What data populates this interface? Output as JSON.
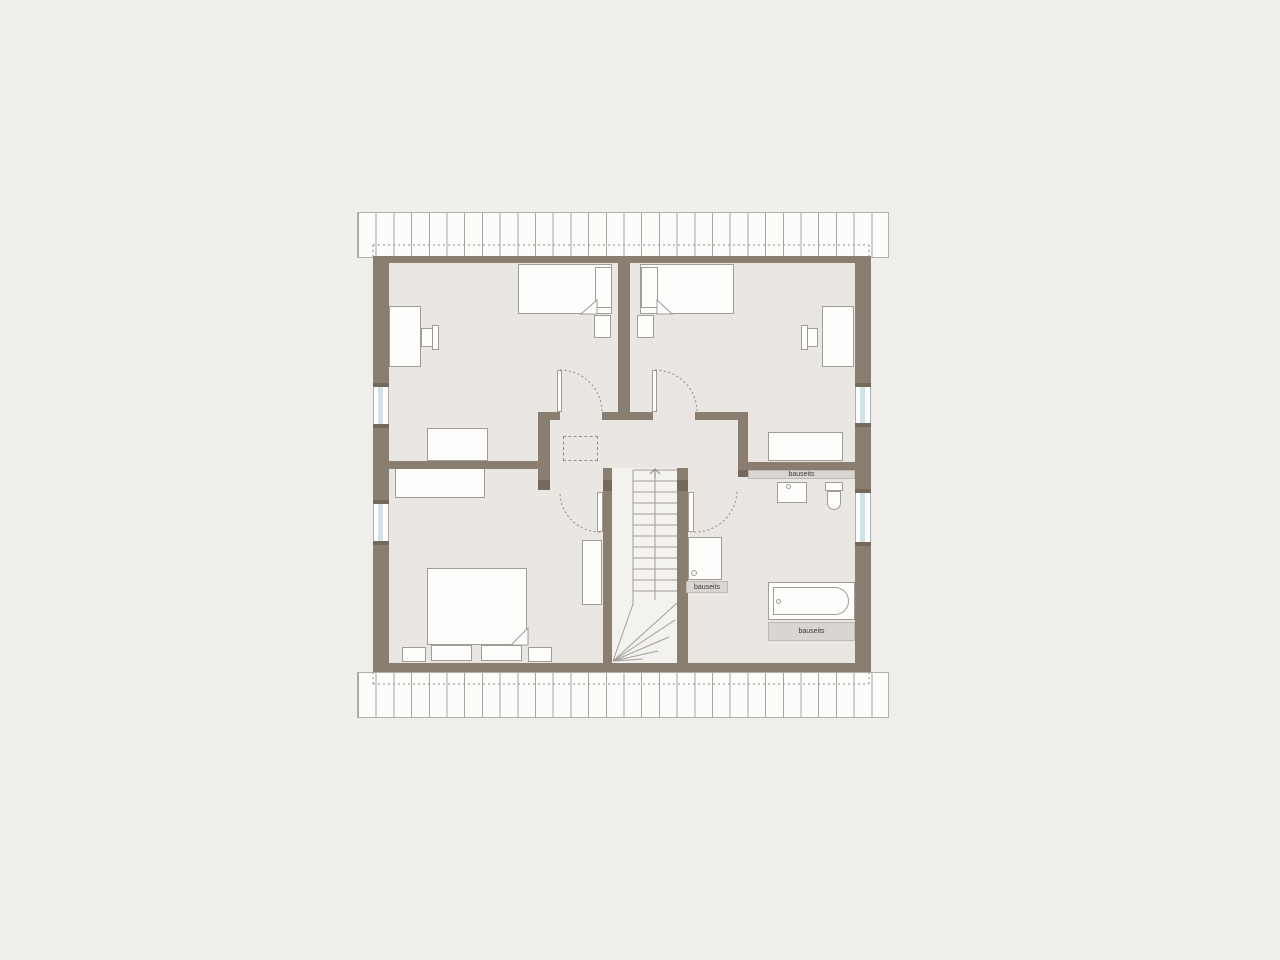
{
  "meta": {
    "description": "attic floor plan drawing"
  },
  "colors": {
    "page_bg": "#f0eeea",
    "room_bg": "#eae6e1",
    "stair_fill": "#f4f2ef",
    "wall": "#8a7e70",
    "wall_dark": "#75695c",
    "hatch_bg": "#fcfcfb",
    "hatch_line": "#a8a5a0",
    "outline": "#a09d98",
    "furniture_fill": "#fdfdfc",
    "window_glass": "#cfe3eb",
    "label_strip_bg": "#d9d6d1",
    "label_text": "#3c3a37",
    "dash_line": "#8f8c86"
  },
  "labels": {
    "bauseits_bath_wall": "bauseits",
    "bauseits_shower": "bauseits",
    "bauseits_tub": "bauseits"
  }
}
